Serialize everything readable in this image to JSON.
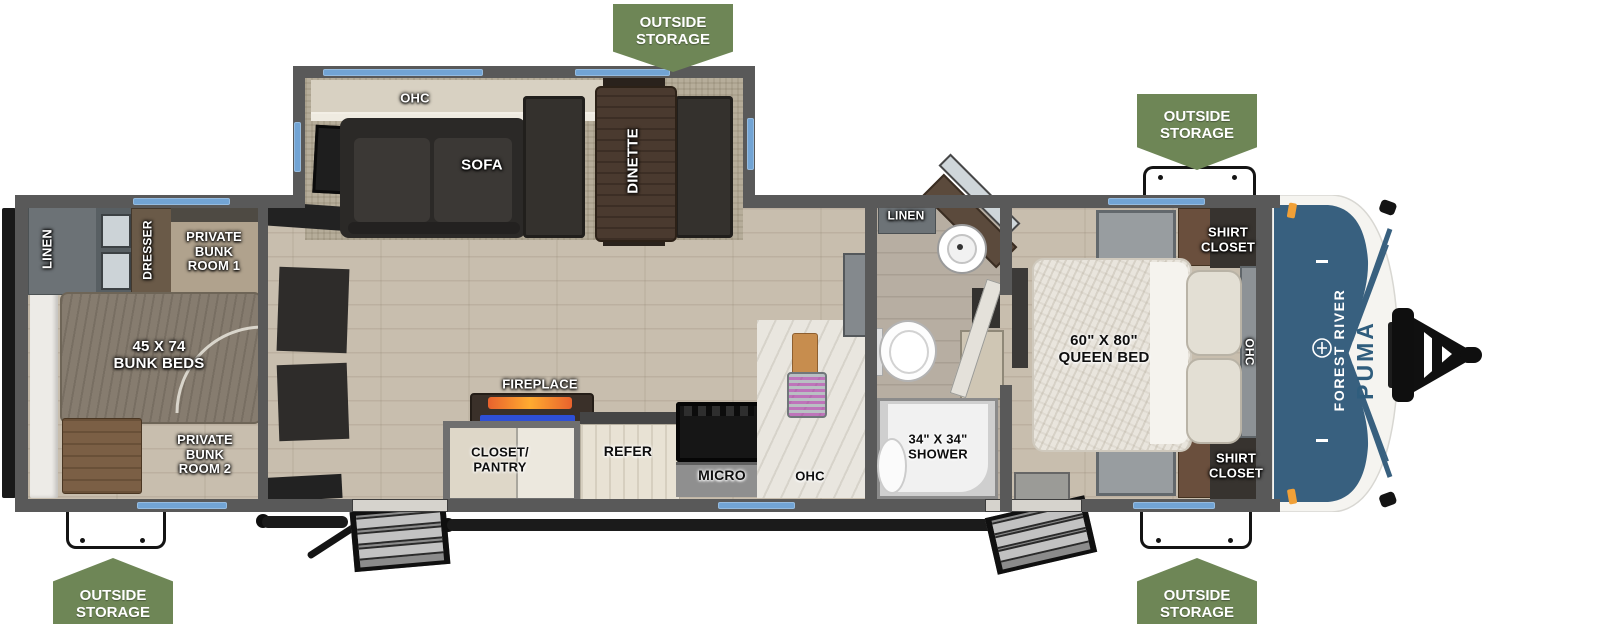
{
  "title": "Forest River Puma travel trailer floorplan",
  "storage_badges": [
    {
      "position": "top-center",
      "label": "OUTSIDE\nSTORAGE"
    },
    {
      "position": "top-right",
      "label": "OUTSIDE\nSTORAGE"
    },
    {
      "position": "bottom-left",
      "label": "OUTSIDE\nSTORAGE"
    },
    {
      "position": "bottom-right",
      "label": "OUTSIDE\nSTORAGE"
    }
  ],
  "living_area": {
    "ohc_label": "OHC",
    "sofa_label": "SOFA",
    "dinette_label": "DINETTE",
    "fireplace_label": "FIREPLACE",
    "closet_pantry_label": "CLOSET/\nPANTRY",
    "refer_label": "REFER",
    "micro_label": "MICRO",
    "ohc_kitchen_label": "OHC"
  },
  "bunk_area": {
    "linen_label": "LINEN",
    "dresser_label": "DRESSER",
    "room1_label": "PRIVATE\nBUNK\nROOM 1",
    "beds_label": "45 X 74\nBUNK BEDS",
    "room2_label": "PRIVATE\nBUNK\nROOM 2"
  },
  "bathroom": {
    "linen_label": "LINEN",
    "shower_label": "34\" X 34\"\nSHOWER"
  },
  "bedroom": {
    "bed_label": "60\" X 80\"\nQUEEN BED",
    "shirt_closet_top_label": "SHIRT\nCLOSET",
    "shirt_closet_bottom_label": "SHIRT\nCLOSET",
    "ohc_label": "OHC"
  },
  "brand": {
    "manufacturer": "FOREST RIVER",
    "model": "PUMA"
  },
  "colors": {
    "badge_green": "#6e8656",
    "window_blue": "#72a4d4",
    "wall_gray": "#595959",
    "cap_blue": "#38607f",
    "marker_orange": "#f0a037",
    "flame_orange": "#e8622d",
    "fireplace_led_blue": "#2e4fd6"
  }
}
